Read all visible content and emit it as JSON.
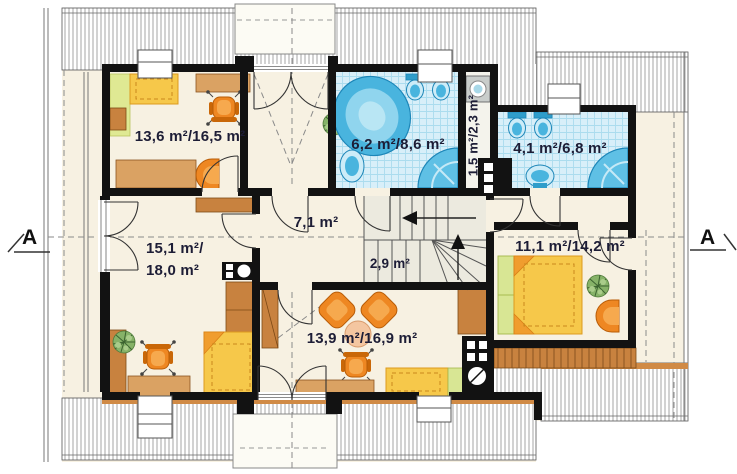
{
  "plan": {
    "title": "attic floor plan",
    "section_marker_left": "A",
    "section_marker_right": "A",
    "rooms": {
      "top_left_room": {
        "area": "13,6 m²/16,5 m²"
      },
      "main_bathroom": {
        "area": "6,2 m²/8,6 m²"
      },
      "utility_closet": {
        "area": "1,5 m²/2,3 m²"
      },
      "small_bathroom": {
        "area": "4,1 m²/6,8 m²"
      },
      "hall": {
        "area": "7,1 m²"
      },
      "staircase": {
        "area": "2,9 m²"
      },
      "left_room": {
        "area_line1": "15,1 m²/",
        "area_line2": "18,0 m²"
      },
      "bottom_room": {
        "area": "13,9 m²/16,9 m²"
      },
      "right_bedroom": {
        "area": "11,1 m²/14,2 m²"
      }
    },
    "colors": {
      "wall": "#121212",
      "floor": "#f7f1e2",
      "bath_tile": "#d8eff9",
      "fixture_blue": "#49b4de",
      "furniture_orange": "#ee8722",
      "furniture_yellow": "#f6c84a",
      "wood": "#c8823f",
      "accent_green": "#d8e694"
    }
  }
}
